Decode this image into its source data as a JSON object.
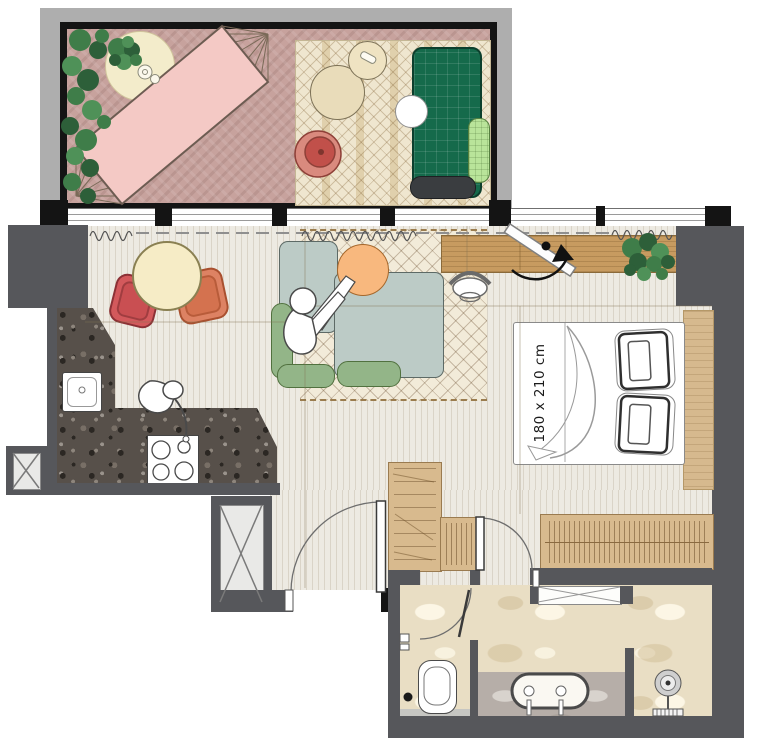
{
  "bed": {
    "size_label": "180 x 210 cm"
  },
  "colors": {
    "wall_dark": "#56575b",
    "wall_black": "#141414",
    "balcony_slab": "#aeaeae",
    "balcony_floor": "#c7a29d",
    "wood_floor": "#edeae2",
    "terrazzo_counter": "#57504a",
    "travertine_floor": "#e9dec4",
    "vanity_marble": "#b6aea8",
    "hammock_pink": "#f4c9c5",
    "daybed_green": "#156a4b",
    "pillow_light_green": "#b9e49a",
    "sofa_blue": "#bccbc6",
    "cushion_green": "#93b588",
    "side_table_orange": "#f8b87e",
    "dining_table_cream": "#f6ecc6",
    "chair_red": "#d3595c",
    "chair_coral": "#dd8263",
    "lounge_chair_red": "#c1504a",
    "desk_wood": "#c79b60",
    "wardrobe_tan": "#d8ba8e",
    "plant_green": "#3f7d49"
  }
}
